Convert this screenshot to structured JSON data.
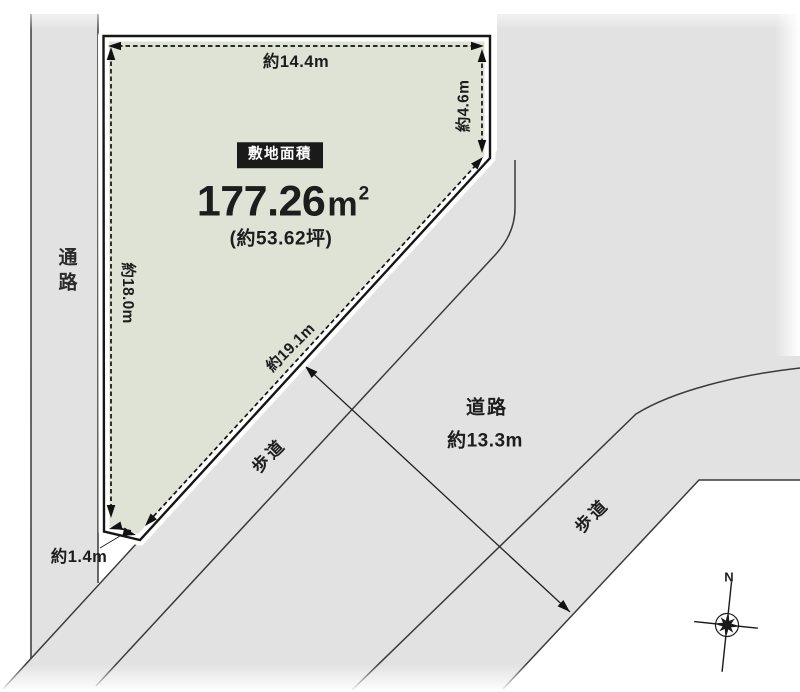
{
  "site": {
    "badge": "敷地面積",
    "area_value": "177.26",
    "area_unit": "m",
    "area_unit_sup": "2",
    "area_alt": "(約53.62坪)"
  },
  "dimensions": {
    "top_edge": "約14.4m",
    "right_edge": "約4.6m",
    "left_edge": "約18.0m",
    "diagonal_edge": "約19.1m",
    "bottom_edge": "約1.4m",
    "road_width": "約13.3m"
  },
  "surroundings": {
    "passage_label": "通路",
    "road_label": "道路",
    "sidewalk_upper_label": "歩道",
    "sidewalk_lower_label": "歩道"
  },
  "compass": {
    "north_label": "N"
  },
  "colors": {
    "plot_fill": "#dfe3d6",
    "road_fill": "#e2e2e3",
    "boundary_line": "#3a3a3a",
    "ink": "#111111",
    "badge_bg": "#1a1a1a",
    "badge_text": "#ffffff"
  }
}
